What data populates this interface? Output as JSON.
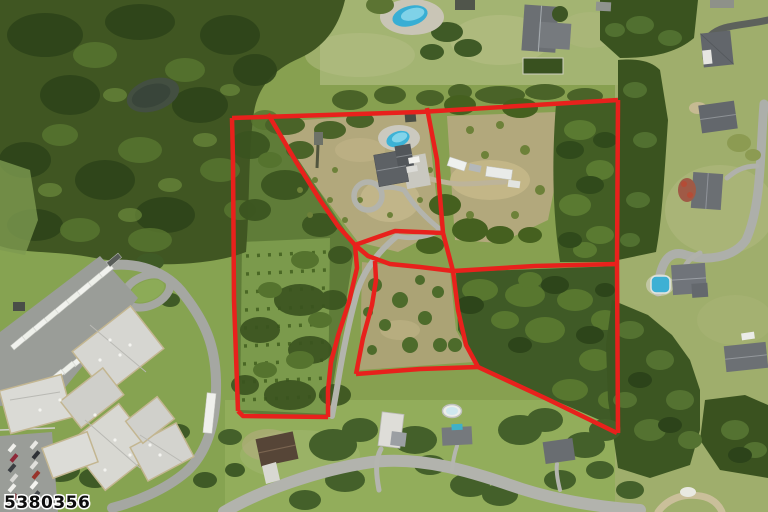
{
  "watermark": {
    "text": "5380356",
    "fill": "#0d0d0d",
    "halo": "#ffffff",
    "font_size": 17
  },
  "overlay": {
    "description": "red property parcel boundary overlay",
    "color": "#e8211c",
    "stroke_width": 4.5,
    "segments": {
      "top-edge": [
        [
          232,
          118
        ],
        [
          420,
          112
        ],
        [
          618,
          100
        ]
      ],
      "right-edge": [
        [
          618,
          100
        ],
        [
          617,
          265
        ],
        [
          618,
          433
        ]
      ],
      "west-edge": [
        [
          238,
          411
        ],
        [
          234,
          300
        ],
        [
          233,
          160
        ],
        [
          232,
          118
        ]
      ],
      "bottom-edge": [
        [
          328,
          417
        ],
        [
          243,
          416
        ],
        [
          238,
          411
        ]
      ],
      "southeast-diagonal": [
        [
          617,
          433
        ],
        [
          545,
          398
        ],
        [
          478,
          367
        ]
      ],
      "south-connector": [
        [
          478,
          367
        ],
        [
          420,
          369
        ],
        [
          356,
          374
        ]
      ],
      "corridor-east-line": [
        [
          356,
          374
        ],
        [
          363,
          338
        ],
        [
          372,
          305
        ],
        [
          376,
          280
        ],
        [
          375,
          261
        ]
      ],
      "corridor-west-line": [
        [
          355,
          245
        ],
        [
          357,
          268
        ],
        [
          349,
          302
        ],
        [
          338,
          336
        ],
        [
          331,
          362
        ],
        [
          328,
          390
        ],
        [
          328,
          417
        ]
      ],
      "northwest-divider": [
        [
          268,
          114
        ],
        [
          295,
          160
        ],
        [
          320,
          200
        ],
        [
          338,
          226
        ],
        [
          355,
          245
        ]
      ],
      "north-divider": [
        [
          427,
          108
        ],
        [
          437,
          160
        ],
        [
          443,
          233
        ],
        [
          453,
          271
        ],
        [
          458,
          310
        ],
        [
          466,
          345
        ],
        [
          478,
          367
        ]
      ],
      "loop-top-line": [
        [
          355,
          245
        ],
        [
          395,
          231
        ],
        [
          443,
          233
        ]
      ],
      "loop-bottom-arc": [
        [
          355,
          245
        ],
        [
          368,
          256
        ],
        [
          390,
          264
        ],
        [
          420,
          267
        ],
        [
          453,
          271
        ]
      ],
      "east-divider": [
        [
          453,
          271
        ],
        [
          535,
          266
        ],
        [
          617,
          264
        ]
      ]
    }
  },
  "scene": {
    "type": "aerial-photo",
    "features": [
      "dense forest with pond (northwest)",
      "evergreen plantation rows (west parcel)",
      "house with pool and circular driveway (subject property)",
      "white trailers on dirt clearing",
      "gravel access corridor driveway",
      "institutional building with bus parking lot (southwest)",
      "neighborhood road with houses (south)",
      "neighboring houses with pools (east)"
    ]
  },
  "colors": {
    "boundary_red": "#e8211c",
    "forest_dark": "#3a531f",
    "forest_mid": "#57752f",
    "field_tan": "#b2a87c",
    "lawn_green": "#8fae58",
    "road_gray": "#b0b1ab",
    "roof_gray": "#64686d",
    "pool_blue": "#3fb2d6",
    "pond_dark": "#39453a",
    "watermark_fill": "#0d0d0d",
    "watermark_halo": "#ffffff"
  }
}
